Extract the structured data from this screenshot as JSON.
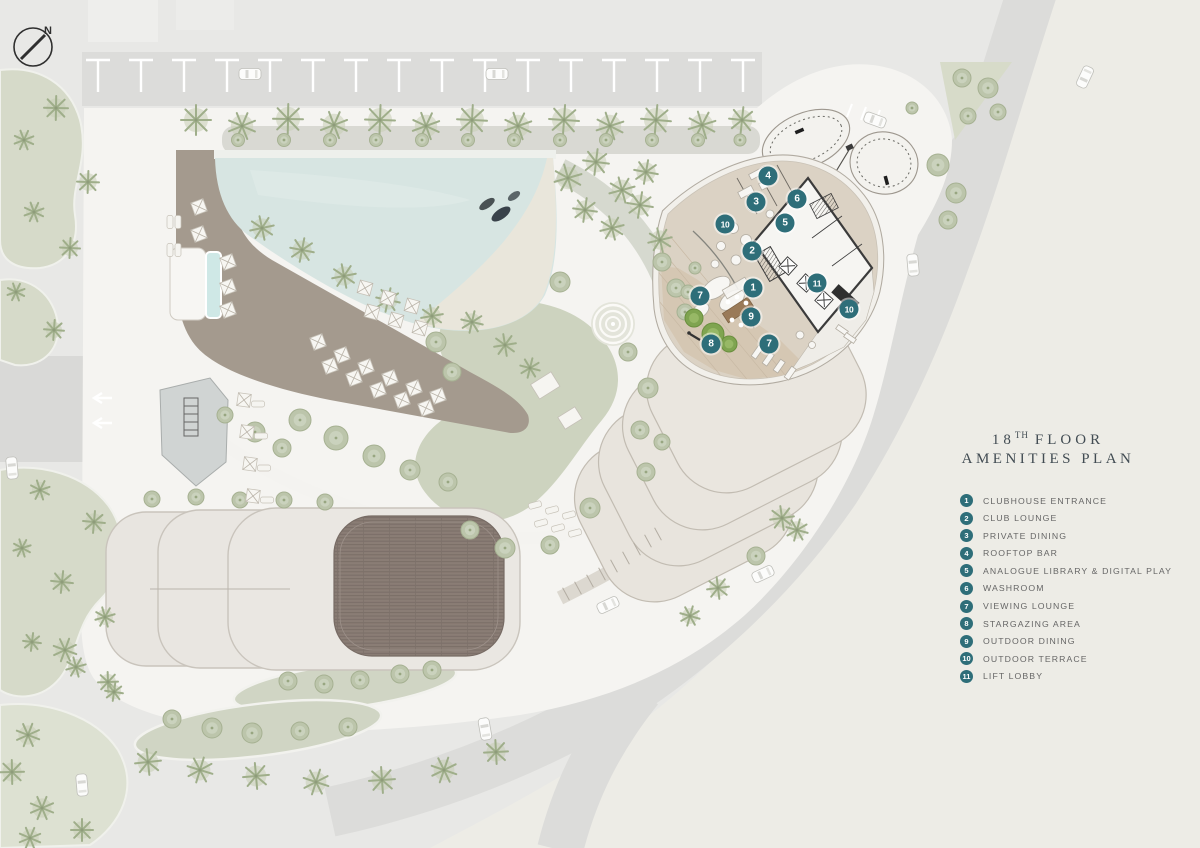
{
  "title": {
    "line1_number": "18",
    "line1_ordinal": "TH",
    "line1_rest": "FLOOR",
    "line2": "AMENITIES PLAN"
  },
  "compass": {
    "label": "N"
  },
  "legend": {
    "items": [
      {
        "num": "1",
        "label": "CLUBHOUSE ENTRANCE"
      },
      {
        "num": "2",
        "label": "CLUB LOUNGE"
      },
      {
        "num": "3",
        "label": "PRIVATE DINING"
      },
      {
        "num": "4",
        "label": "ROOFTOP BAR"
      },
      {
        "num": "5",
        "label": "ANALOGUE LIBRARY & DIGITAL PLAY"
      },
      {
        "num": "6",
        "label": "WASHROOM"
      },
      {
        "num": "7",
        "label": "VIEWING LOUNGE"
      },
      {
        "num": "8",
        "label": "STARGAZING AREA"
      },
      {
        "num": "9",
        "label": "OUTDOOR DINING"
      },
      {
        "num": "10",
        "label": "OUTDOOR TERRACE"
      },
      {
        "num": "11",
        "label": "LIFT LOBBY"
      }
    ]
  },
  "plan": {
    "markers": [
      {
        "num": "1",
        "x": 753,
        "y": 288
      },
      {
        "num": "2",
        "x": 752,
        "y": 251
      },
      {
        "num": "3",
        "x": 756,
        "y": 202
      },
      {
        "num": "4",
        "x": 768,
        "y": 176
      },
      {
        "num": "5",
        "x": 785,
        "y": 223
      },
      {
        "num": "6",
        "x": 797,
        "y": 199
      },
      {
        "num": "7",
        "x": 700,
        "y": 296
      },
      {
        "num": "7",
        "x": 769,
        "y": 344
      },
      {
        "num": "8",
        "x": 711,
        "y": 344
      },
      {
        "num": "9",
        "x": 751,
        "y": 317
      },
      {
        "num": "10",
        "x": 725,
        "y": 224
      },
      {
        "num": "10",
        "x": 849,
        "y": 309
      },
      {
        "num": "11",
        "x": 817,
        "y": 283
      }
    ]
  },
  "colors": {
    "marker_teal": "#2E6E79",
    "title_text": "#424C53",
    "legend_text": "#666666"
  }
}
